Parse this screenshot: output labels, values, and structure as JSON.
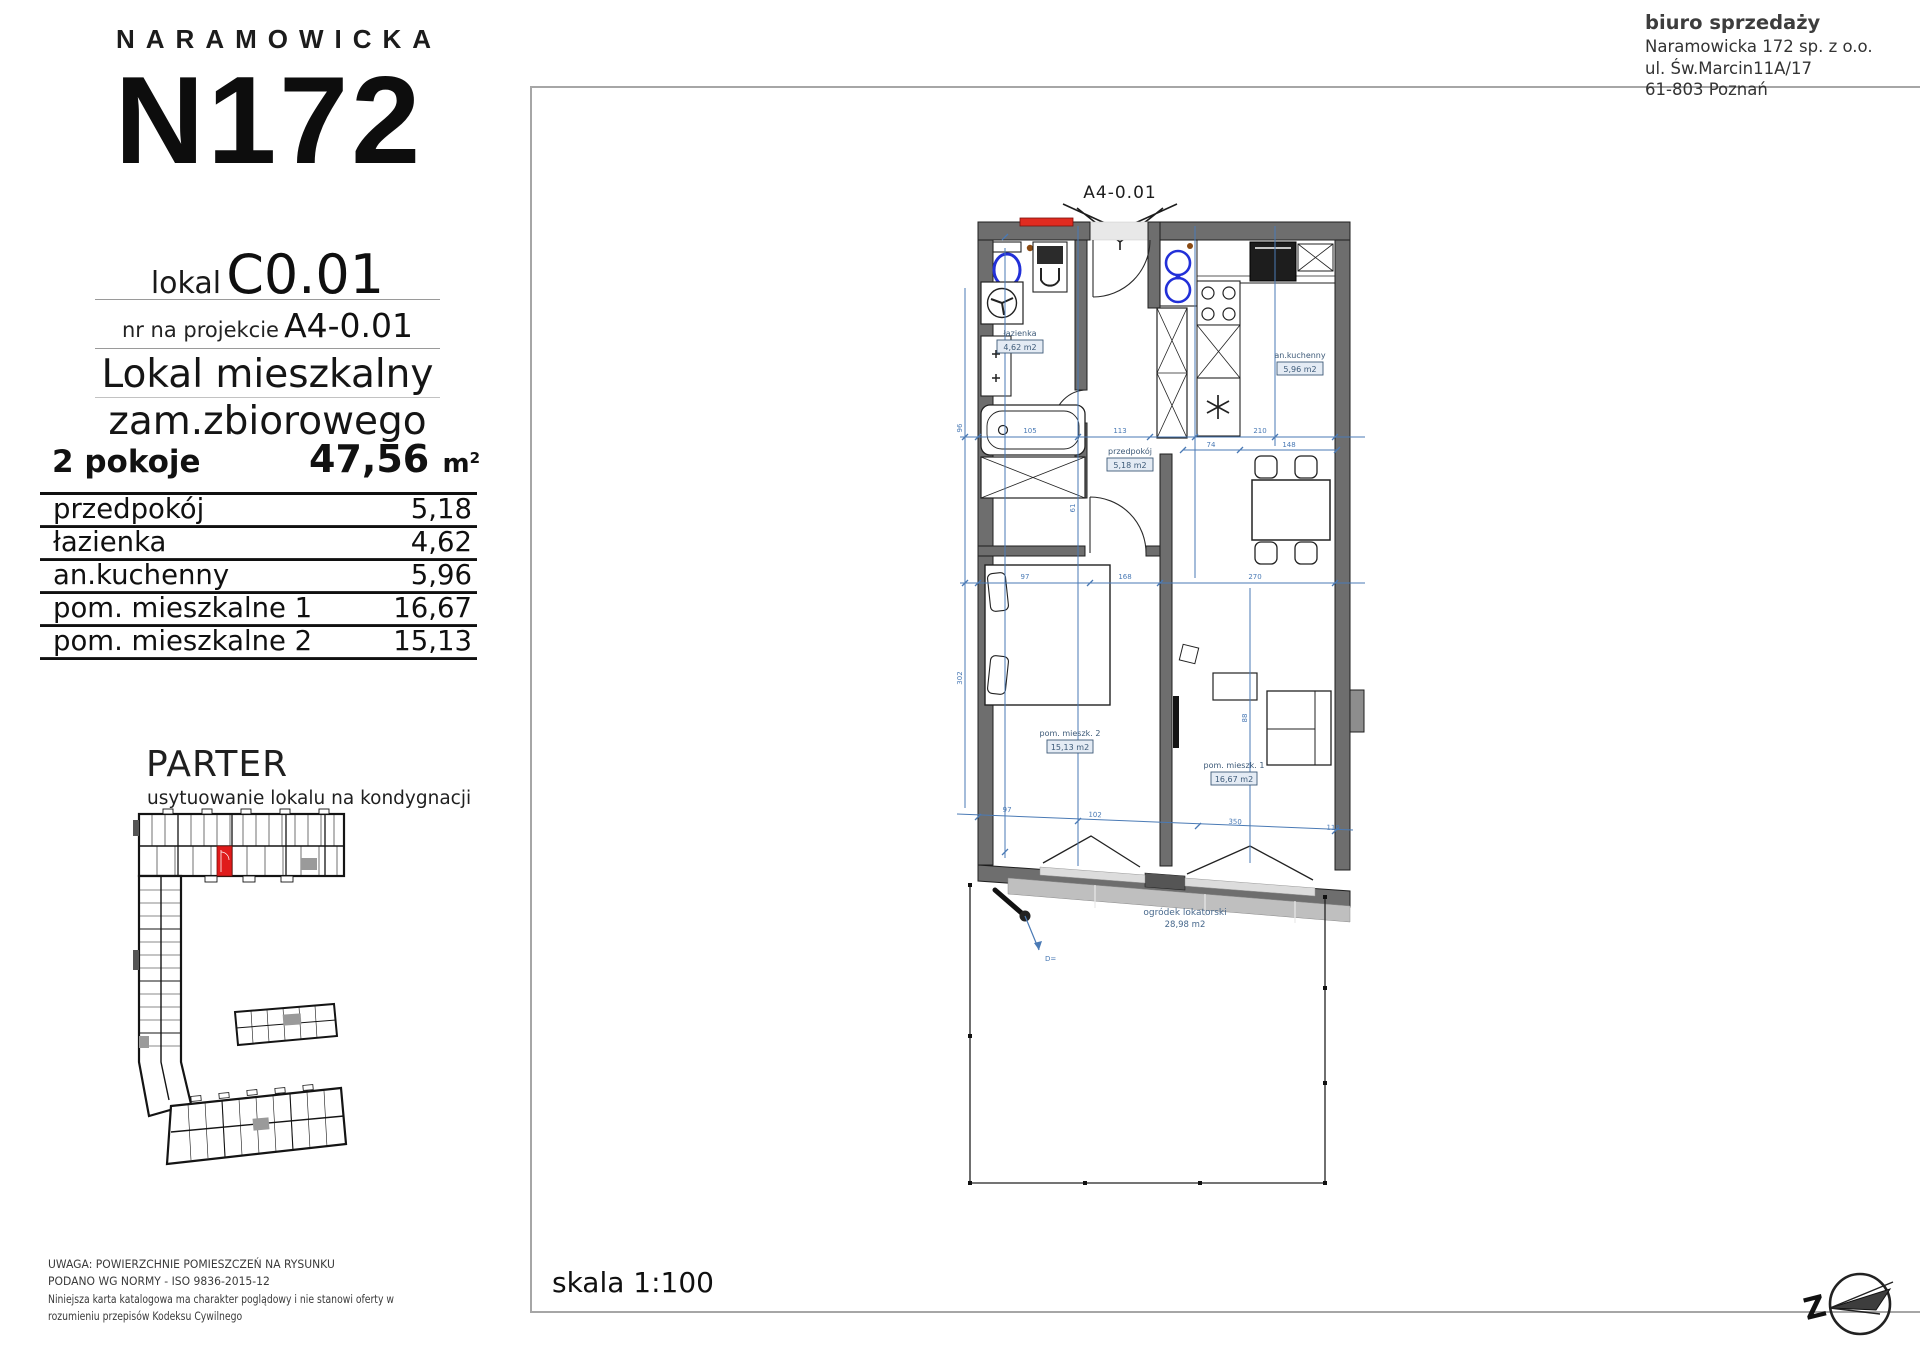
{
  "logo": {
    "brand": "NARAMOWICKA",
    "building": "N172"
  },
  "unit": {
    "lokal_label": "lokal",
    "lokal_number": "C0.01",
    "project_label": "nr na projekcie",
    "project_number": "A4-0.01",
    "type_line1": "Lokal mieszkalny",
    "type_line2": "zam.zbiorowego",
    "rooms_count": "2 pokoje",
    "area_value": "47,56",
    "area_unit": "m",
    "area_sup": "2"
  },
  "rooms_table": {
    "rows": [
      {
        "name": "przedpokój",
        "area": "5,18"
      },
      {
        "name": "łazienka",
        "area": "4,62"
      },
      {
        "name": "an.kuchenny",
        "area": "5,96"
      },
      {
        "name": "pom. mieszkalne 1",
        "area": "16,67"
      },
      {
        "name": "pom. mieszkalne 2",
        "area": "15,13"
      }
    ]
  },
  "floor": {
    "name": "PARTER",
    "caption": "usytuowanie lokalu na kondygnacji"
  },
  "disclaimer": {
    "line1": "UWAGA: POWIERZCHNIE POMIESZCZEŃ NA RYSUNKU",
    "line2": "PODANO WG NORMY - ISO 9836-2015-12",
    "line3": "Niniejsza karta katalogowa ma charakter poglądowy i nie stanowi oferty w",
    "line4": "rozumieniu przepisów Kodeksu Cywilnego"
  },
  "office": {
    "title": "biuro sprzedaży",
    "company": "Naramowicka 172 sp. z o.o.",
    "street": "ul. Św.Marcin11A/17",
    "city": "61-803 Poznań"
  },
  "plan": {
    "marker": "A4-0.01",
    "scale_label": "skala 1:100",
    "compass_letter": "Z",
    "drain_label": "D=",
    "labels": {
      "bathroom": {
        "name": "łazienka",
        "area": "4,62 m2"
      },
      "hall": {
        "name": "przedpokój",
        "area": "5,18 m2"
      },
      "kitchen": {
        "name": "an.kuchenny",
        "area": "5,96 m2"
      },
      "room2": {
        "name": "pom. mieszk. 2",
        "area": "15,13 m2"
      },
      "room1": {
        "name": "pom. mieszk. 1",
        "area": "16,67 m2"
      },
      "garden": {
        "name": "ogródek lokatorski",
        "area": "28,98 m2"
      }
    },
    "dims": {
      "h1": [
        "105",
        "113",
        "210"
      ],
      "h2": [
        "74",
        "148"
      ],
      "h3": [
        "97",
        "168",
        "270"
      ],
      "h4": [
        "97",
        "102",
        "350",
        "119"
      ],
      "v": [
        "96",
        "302",
        "88",
        "61"
      ]
    },
    "colors": {
      "wall": "#6e6e6e",
      "dimension": "#4a7ab5",
      "fixture": "#2230d8",
      "accent_red": "#e02b20",
      "minimap_unit": "#e01b1b"
    }
  }
}
